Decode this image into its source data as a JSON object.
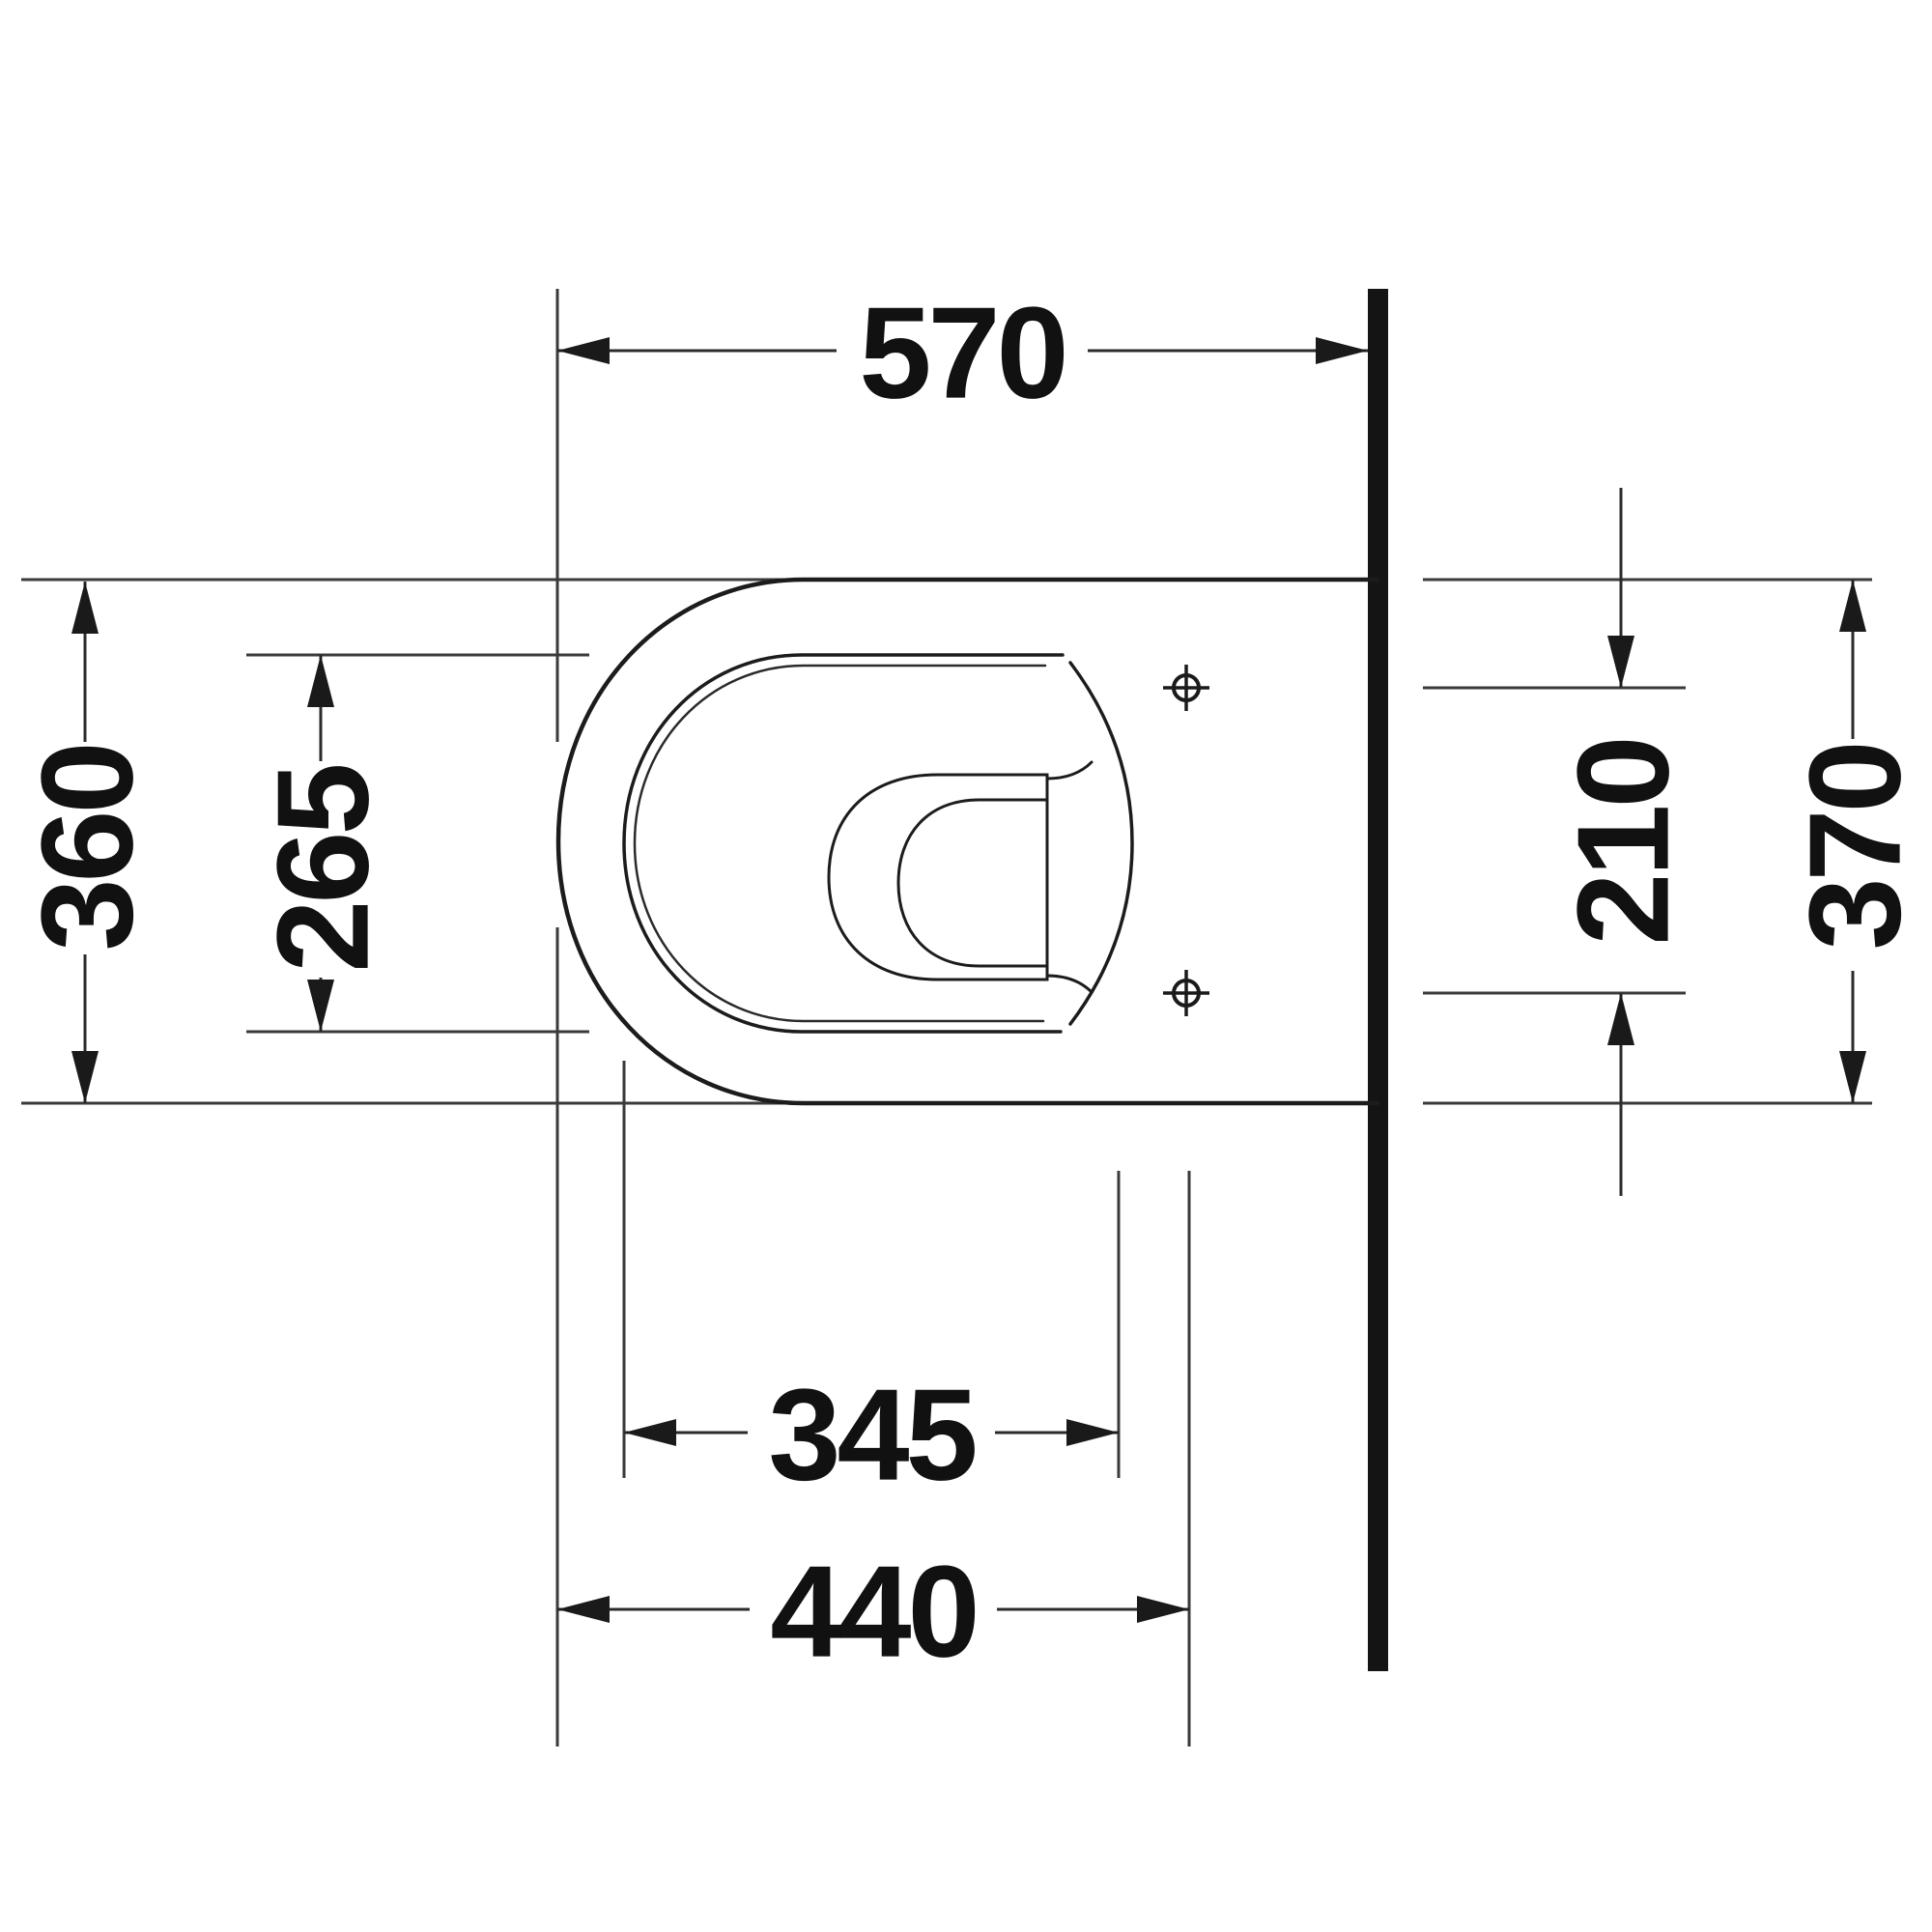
{
  "drawing": {
    "kind": "technical-dimension-drawing-top-view",
    "dimensions": {
      "top_depth": "570",
      "left_outer_width": "360",
      "left_seat_opening_width": "265",
      "right_hole_spacing": "210",
      "right_overall_width": "370",
      "bottom_seat_length": "345",
      "bottom_hole_distance": "440"
    },
    "symbols": {
      "fixing_hole": "crosshair-circle",
      "wall": "solid-black-bar"
    },
    "colors": {
      "background": "#ffffff",
      "outline": "#1c1c1c",
      "thin_line": "#3a3a3a",
      "wall": "#141414",
      "text": "#111111"
    }
  }
}
